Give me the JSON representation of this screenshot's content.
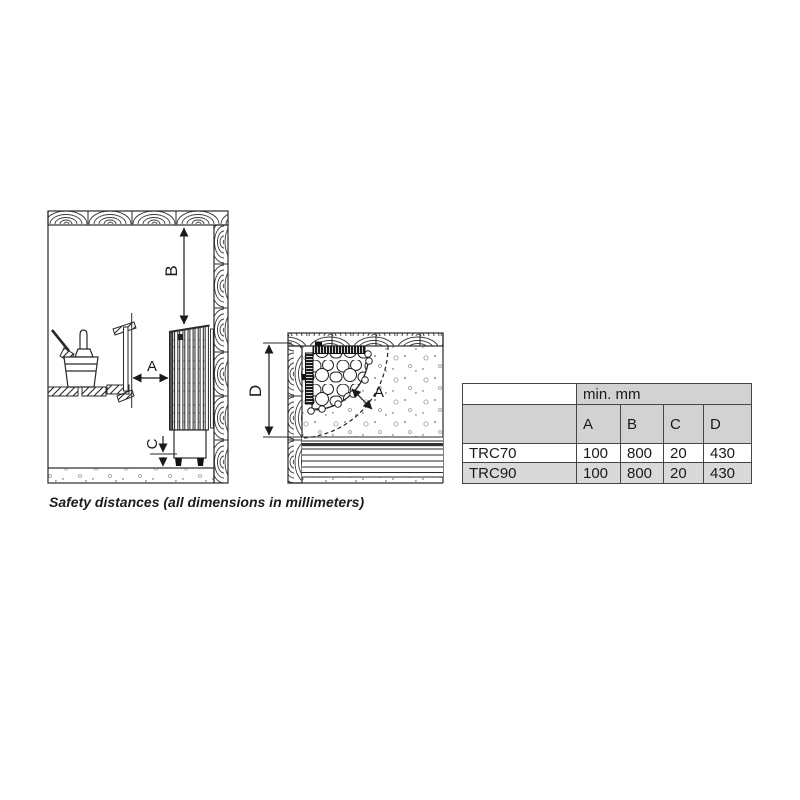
{
  "side_view": {
    "a": "A",
    "b": "B",
    "c": "C"
  },
  "top_view": {
    "a": "A",
    "d": "D"
  },
  "table": {
    "unit_header": "min. mm",
    "columns": [
      "A",
      "B",
      "C",
      "D"
    ],
    "rows": [
      {
        "model": "TRC70",
        "values": [
          "100",
          "800",
          "20",
          "430"
        ]
      },
      {
        "model": "TRC90",
        "values": [
          "100",
          "800",
          "20",
          "430"
        ]
      }
    ]
  },
  "caption": "Safety distances (all dimensions in millimeters)",
  "colors": {
    "line": "#2a2a2a",
    "table_border": "#454545",
    "header_bg": "#d2d2d2",
    "alt_row_bg": "#d9d9d9",
    "row_bg": "#ffffff"
  }
}
